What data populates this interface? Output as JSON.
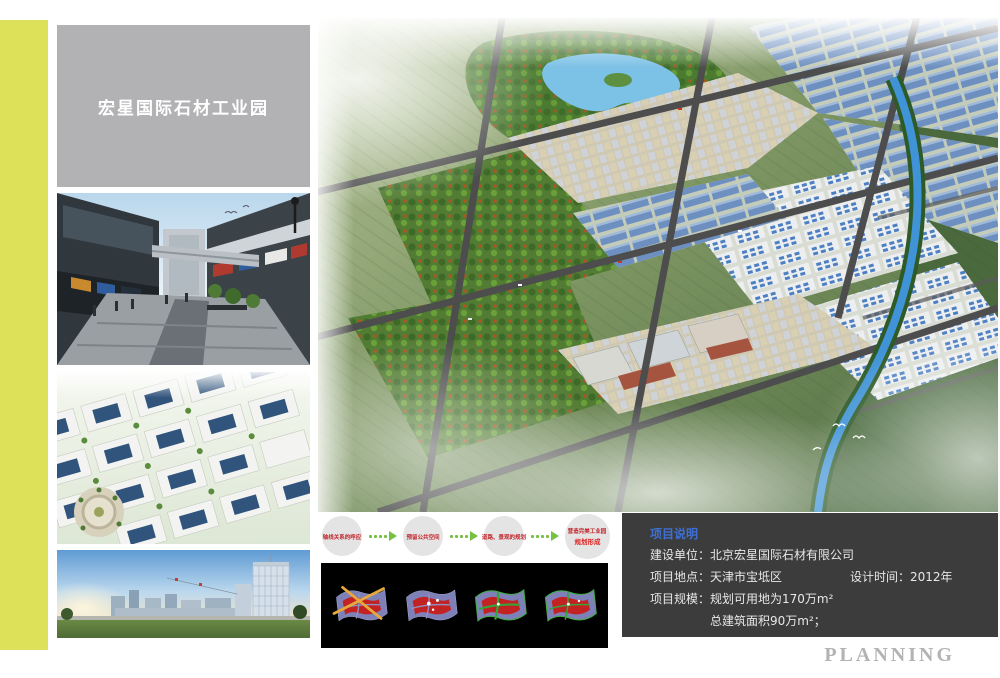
{
  "page": {
    "background": "#ffffff",
    "accent_stripe_color": "#dce159",
    "planning_label": "PLANNING"
  },
  "header": {
    "title": "宏星国际石材工业园",
    "box_color": "#b2b2b4",
    "text_color": "#ffffff"
  },
  "flow": {
    "circle_color": "#e4e4e4",
    "arrow_color": "#76c043",
    "text_color": "#c1272d",
    "steps": [
      {
        "label": "轴线关系的呼应"
      },
      {
        "label": "预留公共空间"
      },
      {
        "label": "道路、景观的规划"
      },
      {
        "label": "营造完美工业园",
        "sublabel": "规划形成"
      }
    ]
  },
  "diagram_panel": {
    "background": "#000000",
    "items": [
      {
        "icon": "axis-concept-icon"
      },
      {
        "icon": "node-concept-icon"
      },
      {
        "icon": "road-network-concept-icon"
      },
      {
        "icon": "final-plan-concept-icon"
      }
    ]
  },
  "project_info": {
    "heading": "项目说明",
    "heading_color": "#3f6fd1",
    "box_color": "#3c3c3c",
    "text_color": "#e8e8e8",
    "line1_label": "建设单位：",
    "line1_value": "北京宏星国际石材有限公司",
    "line2_label": "项目地点：",
    "line2_value": "天津市宝坻区",
    "line2_right": "设计时间：2012年",
    "line3_label": "项目规模：",
    "line3_value": "规划可用地为170万m²",
    "line4_value": "总建筑面积90万m²；"
  }
}
